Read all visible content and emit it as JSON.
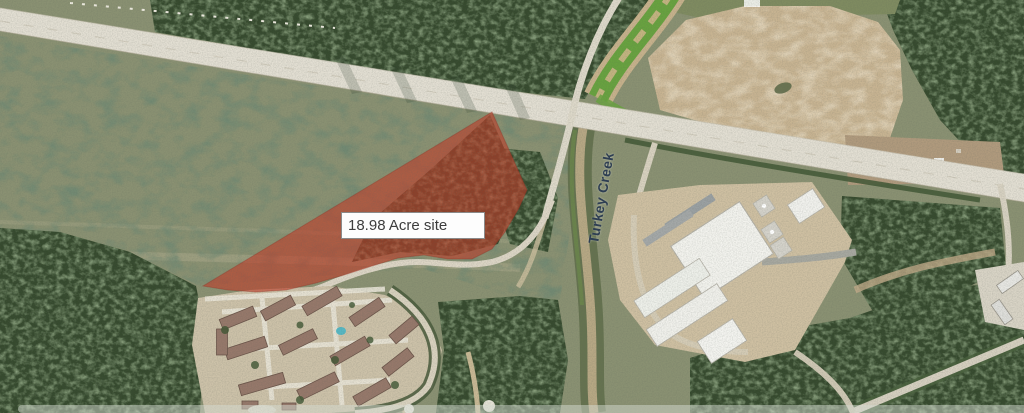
{
  "map": {
    "annotations": {
      "site_label": "18.98 Acre site",
      "road_label": "Turkey Creek"
    },
    "colors": {
      "overlay_red": "#c23b28",
      "field_green": "#8a9172",
      "forest_green": "#35492d",
      "dirt_tan": "#c8b492",
      "road_light": "#e3dfd3",
      "building_white": "#f3f3ee",
      "roof_brown": "#96786a",
      "pool_teal": "#57b8c4",
      "site_label_text": "#3d3d3d",
      "road_label_text": "#2e3e52"
    }
  }
}
